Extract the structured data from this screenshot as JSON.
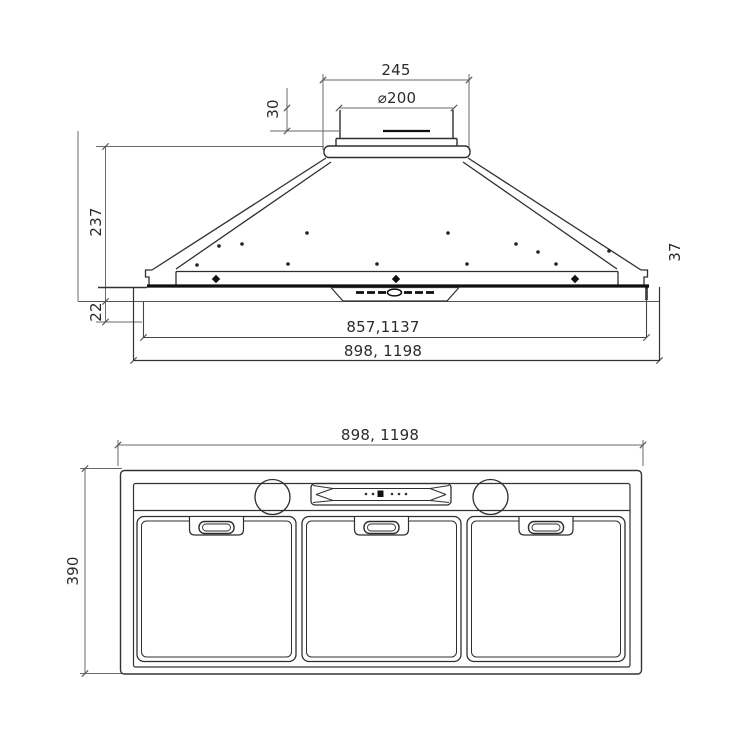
{
  "colors": {
    "background": "#ffffff",
    "outline": "#2f2f2f",
    "dimension_line": "#6a6a6a",
    "heavy_line": "#0f0f0f",
    "text": "#2b2b2b"
  },
  "front_view": {
    "dims": {
      "cap_width": "245",
      "duct_diameter": "⌀200",
      "duct_stub_height": "30",
      "hood_height": "237",
      "visible_rim_height": "22",
      "cutout_width": "857,1137",
      "overall_width": "898, 1198",
      "flange_height": "37"
    }
  },
  "plan_view": {
    "dims": {
      "overall_width": "898, 1198",
      "overall_depth": "390"
    }
  }
}
